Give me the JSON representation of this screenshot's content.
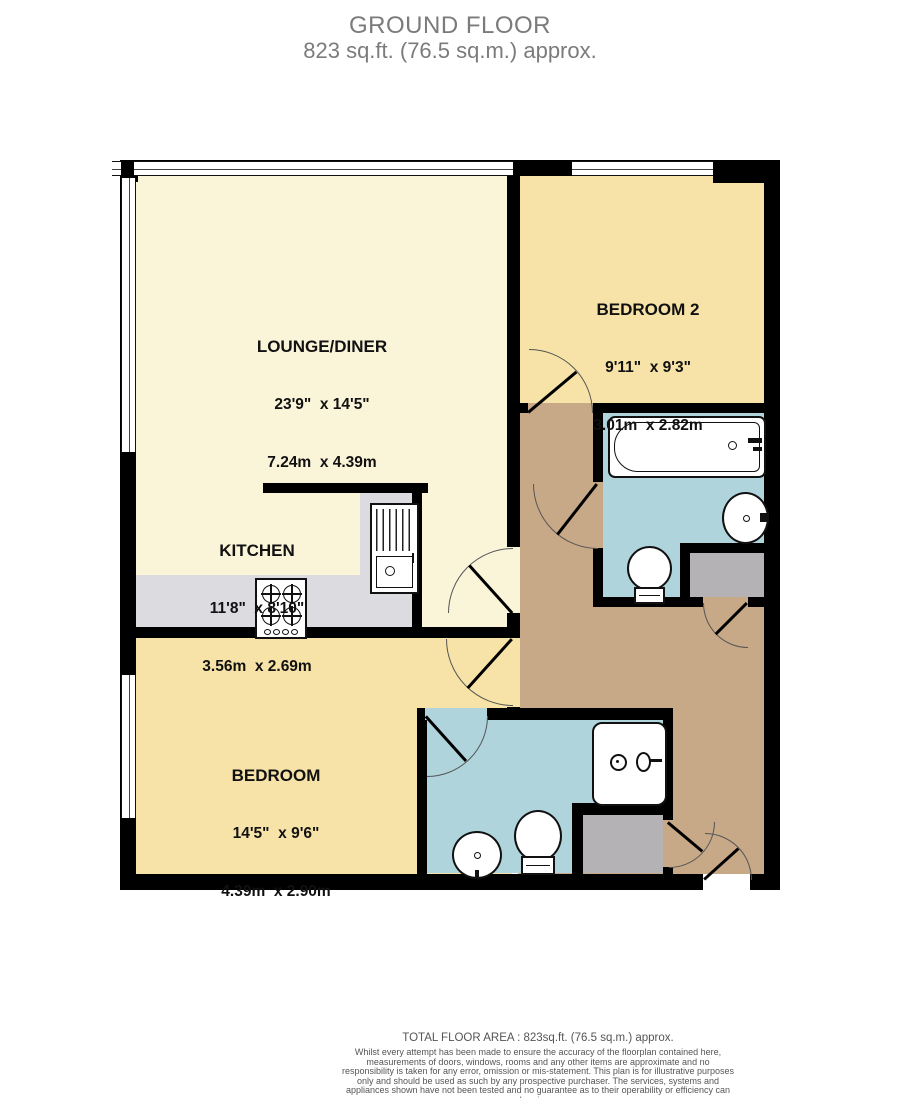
{
  "header": {
    "title": "GROUND FLOOR",
    "subtitle": "823 sq.ft. (76.5 sq.m.) approx."
  },
  "rooms": {
    "lounge": {
      "name": "LOUNGE/DINER",
      "imperial": "23'9\"  x 14'5\"",
      "metric": "7.24m  x 4.39m"
    },
    "bedroom2": {
      "name": "BEDROOM 2",
      "imperial": "9'11\"  x 9'3\"",
      "metric": "3.01m  x 2.82m"
    },
    "kitchen": {
      "name": "KITCHEN",
      "imperial": "11'8\"  x 8'10\"",
      "metric": "3.56m  x 2.69m"
    },
    "bedroom": {
      "name": "BEDROOM",
      "imperial": "14'5\"  x 9'6\"",
      "metric": "4.39m  x 2.90m"
    }
  },
  "footer": {
    "total_area": "TOTAL FLOOR AREA : 823sq.ft. (76.5 sq.m.) approx.",
    "disclaimer": "Whilst every attempt has been made to ensure the accuracy of the floorplan contained here, measurements of doors, windows, rooms and any other items are approximate and no responsibility is taken for any error, omission or mis-statement. This plan is for illustrative purposes only and should be used as such by any prospective purchaser. The services, systems and appliances shown have not been tested and no guarantee as to their operability or efficiency can be given.",
    "credit": "Made with Metropix ©2025"
  },
  "colors": {
    "lounge_floor": "#FAF4D9",
    "bedroom_floor": "#F7E3A8",
    "hallway_floor": "#C7A887",
    "bathroom_floor": "#AFD4DC",
    "counter_gray": "#DCDCE0",
    "cupboard_gray": "#B4B2B4",
    "wall": "#000000",
    "title_gray": "#7B7B7B"
  }
}
